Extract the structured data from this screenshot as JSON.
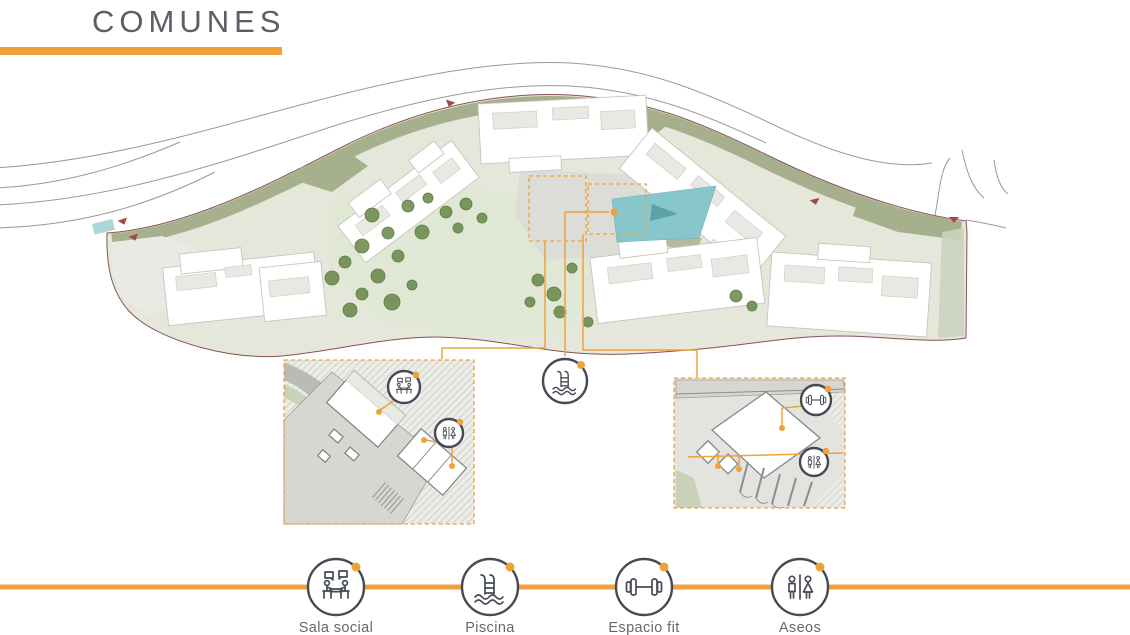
{
  "header": {
    "title": "COMUNES"
  },
  "legend": {
    "items": [
      {
        "id": "sala-social",
        "label": "Sala social"
      },
      {
        "id": "piscina",
        "label": "Piscina"
      },
      {
        "id": "espacio-fit",
        "label": "Espacio fit"
      },
      {
        "id": "aseos",
        "label": "Aseos"
      }
    ]
  },
  "colors": {
    "accent": "#EFA23B",
    "ink": "#454B55",
    "title": "#5A5F66",
    "label": "#63686F",
    "parcel": "#E4E7DA",
    "olive": "#A7B08D",
    "pool": "#87C6CA",
    "boundary": "#8A5252",
    "bldg_line": "#C6C6C0",
    "road": "#9A9A96",
    "tree": "#6D8E4F"
  }
}
